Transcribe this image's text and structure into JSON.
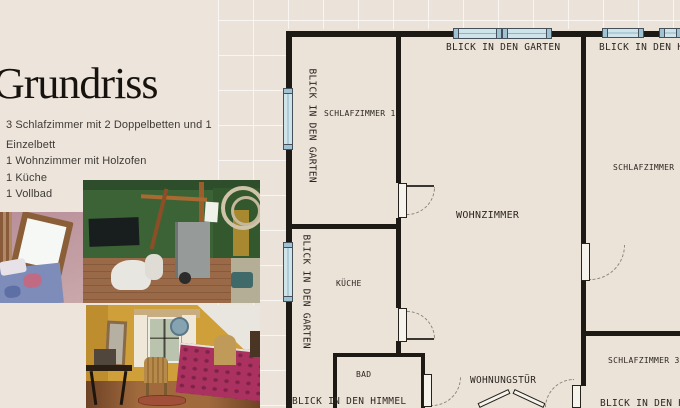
{
  "left_panel": {
    "title": "Grundriss",
    "features": [
      "3 Schlafzimmer mit 2 Doppelbetten und 1",
      "Einzelbett",
      "1 Wohnzimmer mit Holzofen",
      "1 Küche",
      "1 Vollbad"
    ],
    "photos": [
      "attic-bedroom",
      "green-living-room",
      "yellow-bedroom"
    ]
  },
  "floor_plan": {
    "rooms": {
      "schlafzimmer1": "SCHLAFZIMMER 1",
      "wohnzimmer": "WOHNZIMMER",
      "kueche": "KÜCHE",
      "bad": "BAD",
      "schlafzimmer2": "SCHLAFZIMMER 2",
      "schlafzimmer3": "SCHLAFZIMMER 3",
      "wohnungstuer": "WOHNUNGSTÜR"
    },
    "views": {
      "garten": "BLICK IN DEN GARTEN",
      "himmel": "BLICK IN DEN HIMMEL"
    },
    "colors": {
      "wall": "#1d1a16",
      "paper": "#ece3d8",
      "window": "#cfe3ea",
      "background": "#ebe3da"
    }
  }
}
